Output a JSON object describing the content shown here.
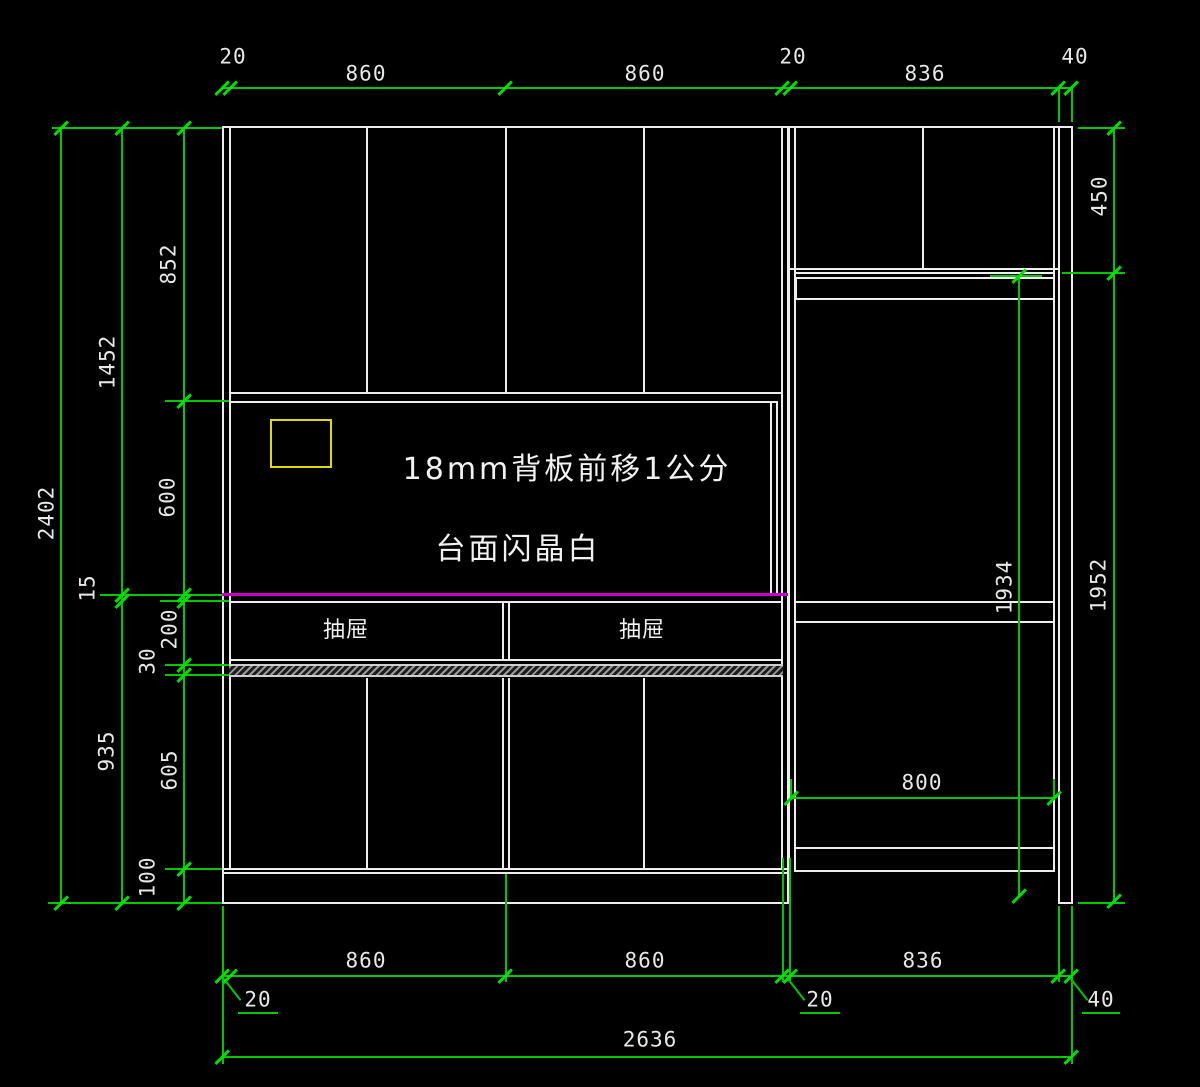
{
  "title": "cabinet elevation CAD drawing",
  "annotations": {
    "backboard": "18mm背板前移1公分",
    "countertop": "台面闪晶白",
    "drawer_left": "抽屉",
    "drawer_right": "抽屉"
  },
  "dims": {
    "top": {
      "t20a": "20",
      "t860a": "860",
      "t860b": "860",
      "t20b": "20",
      "t836": "836",
      "t40": "40"
    },
    "bottom": {
      "b860a": "860",
      "b860b": "860",
      "b836": "836",
      "b20a": "20",
      "b20b": "20",
      "b40": "40",
      "b2636": "2636"
    },
    "left": {
      "l2402": "2402",
      "l1452": "1452",
      "l852": "852",
      "l600": "600",
      "l15": "15",
      "l200": "200",
      "l30": "30",
      "l935": "935",
      "l605": "605",
      "l100": "100"
    },
    "right": {
      "r450": "450",
      "r1952": "1952",
      "r1934": "1934",
      "r800": "800"
    }
  },
  "colors": {
    "background": "#000000",
    "cabinet_line": "#ededed",
    "dimension_green": "#00c800",
    "text_white": "#e8e8e8",
    "countertop_magenta": "#c800c8",
    "highlight_yellow": "#dcdc00"
  }
}
